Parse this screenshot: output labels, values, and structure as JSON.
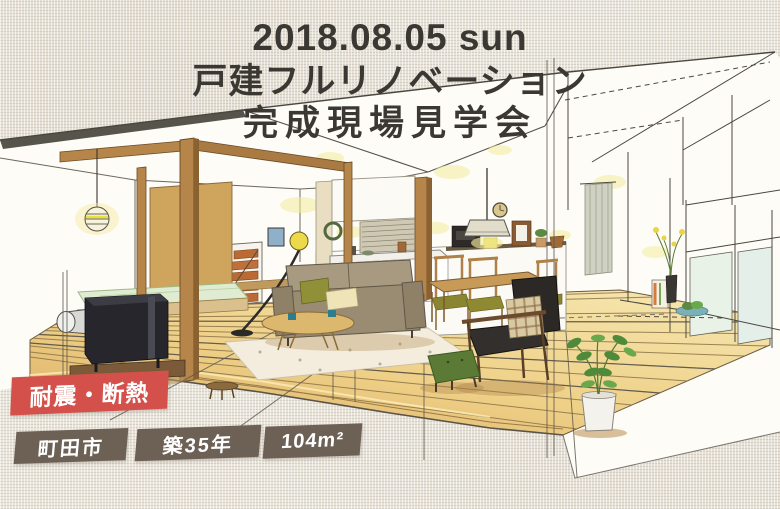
{
  "page": {
    "type": "renovation-open-house-flyer"
  },
  "event": {
    "date": "2018.08.05 sun",
    "title_line1": "戸建フルリノベーション",
    "title_line2": "完成現場見学会"
  },
  "badges": {
    "feature": "耐震・断熱",
    "location": "町田市",
    "building_age": "築35年",
    "floor_area": "104m²"
  },
  "colors": {
    "background_linen": "#e8e3d9",
    "title_text": "#3b3834",
    "feature_badge_bg": "#d4504b",
    "info_badge_bg": "#6d6054",
    "badge_text": "#ffffff",
    "ink_line": "#4b473f",
    "wood_floor": "#e9c87c",
    "wood_post": "#b5854a",
    "tatami_green": "#dfecd2",
    "sofa_taupe": "#9a8c72",
    "ottoman_green": "#5b7a35",
    "lamp_glow_yellow": "#f4ec9c"
  },
  "illustration": {
    "name": "interior-perspective-illustration",
    "elements": [
      "wood-stove",
      "tatami-platform",
      "ball-pendant-lamp",
      "fusuma-panel",
      "wood-posts",
      "stairs",
      "kitchen-counter",
      "wall-shelf",
      "pendant-lamp",
      "wall-clock",
      "dining-table",
      "dining-chairs",
      "curtain",
      "window-bay",
      "flower-vase",
      "sofa",
      "cushions",
      "coffee-table",
      "rug",
      "floor-lamp",
      "armchair",
      "plaid-cushion",
      "ottoman",
      "potted-plant",
      "side-stool",
      "wall-picture",
      "wreath"
    ]
  }
}
